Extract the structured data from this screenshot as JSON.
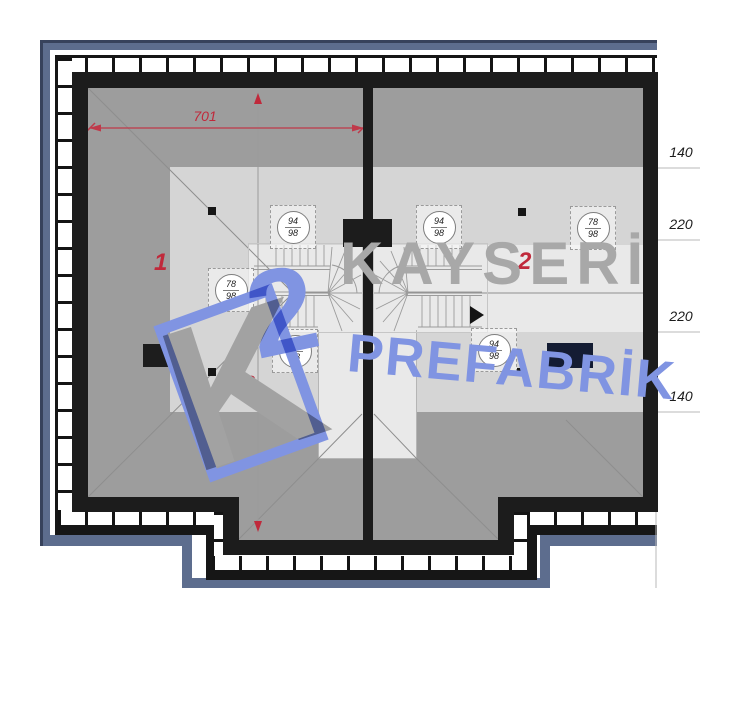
{
  "plan": {
    "unit_labels": [
      "1",
      "2"
    ],
    "dims": {
      "width": "701",
      "depth": "1155",
      "right": [
        "140",
        "220",
        "220",
        "140"
      ]
    },
    "tags": [
      {
        "top": "94",
        "bottom": "98"
      },
      {
        "top": "78",
        "bottom": "98"
      },
      {
        "top": "94",
        "bottom": "98"
      },
      {
        "top": "94",
        "bottom": "98"
      },
      {
        "top": "78",
        "bottom": "98"
      },
      {
        "top": "94",
        "bottom": "98"
      }
    ]
  },
  "watermark": {
    "line1": "KAYSERİ",
    "line2": "PREFABRİK",
    "logo_k": "K",
    "logo_2": "2"
  },
  "colors": {
    "border_slate": "#5d6d8e",
    "wall_black": "#1c1c1c",
    "roof_dark": "#9d9d9d",
    "roof_mid": "#d5d5d5",
    "roof_light": "#e9e9e9",
    "dim_red": "#c0293b",
    "watermark_gray": "#a8a8a8",
    "watermark_blue": "#8094e2",
    "navy_rect": "#141c33"
  }
}
